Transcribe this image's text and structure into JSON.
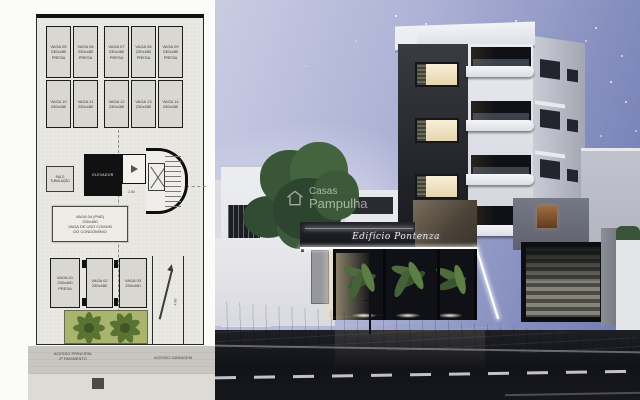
{
  "floor_plan": {
    "row1": [
      {
        "label": "VAGA 05",
        "dim": "230x480",
        "note": "PRESA"
      },
      {
        "label": "VAGA 06",
        "dim": "230x480",
        "note": "PRESA"
      },
      {
        "label": "VAGA 07",
        "dim": "230x480",
        "note": "PRESA"
      },
      {
        "label": "VAGA 08",
        "dim": "230x480",
        "note": "PRESA"
      },
      {
        "label": "VAGA 09",
        "dim": "230x480",
        "note": "PRESA"
      }
    ],
    "row2": [
      {
        "label": "VAGA 10",
        "dim": "230x480",
        "note": ""
      },
      {
        "label": "VAGA 11",
        "dim": "230x480",
        "note": ""
      },
      {
        "label": "VAGA 12",
        "dim": "230x480",
        "note": ""
      },
      {
        "label": "VAGA 13",
        "dim": "230x480",
        "note": ""
      },
      {
        "label": "VAGA 14",
        "dim": "230x480",
        "note": ""
      }
    ],
    "bottom": [
      {
        "label": "VAGA 01",
        "dim": "230x480",
        "note": "PRESA"
      },
      {
        "label": "VAGA 02",
        "dim": "230x480",
        "note": ""
      },
      {
        "label": "VAGA 03",
        "dim": "230x480",
        "note": ""
      }
    ],
    "pne_lines": [
      "VAGA 04 (PNE)",
      "230x480",
      "VAGA DE USO COMUM",
      "DO CONDOMÍNIO"
    ],
    "elevator_label": "ELEVADOR",
    "utility_label": "RALO TUBULAÇÃO",
    "stair_dim": "2.80",
    "ramp_dim": "4.80",
    "access_main_line1": "ACESSO PRINCIPAL",
    "access_main_line2": "2º PAVIMENTO",
    "access_garage": "ACESSO GARAGEM"
  },
  "render": {
    "building_name": "Edifício Pontenza",
    "watermark_line1": "Casas",
    "watermark_line2": "Pampulha"
  },
  "colors": {
    "sky_top": "#6d77ae",
    "sky_horizon": "#c9cce2",
    "garden_green": "#a9b46c",
    "led_white": "#ffffff",
    "street_dark": "#17181c",
    "plan_fill": "#d8d7d2"
  }
}
